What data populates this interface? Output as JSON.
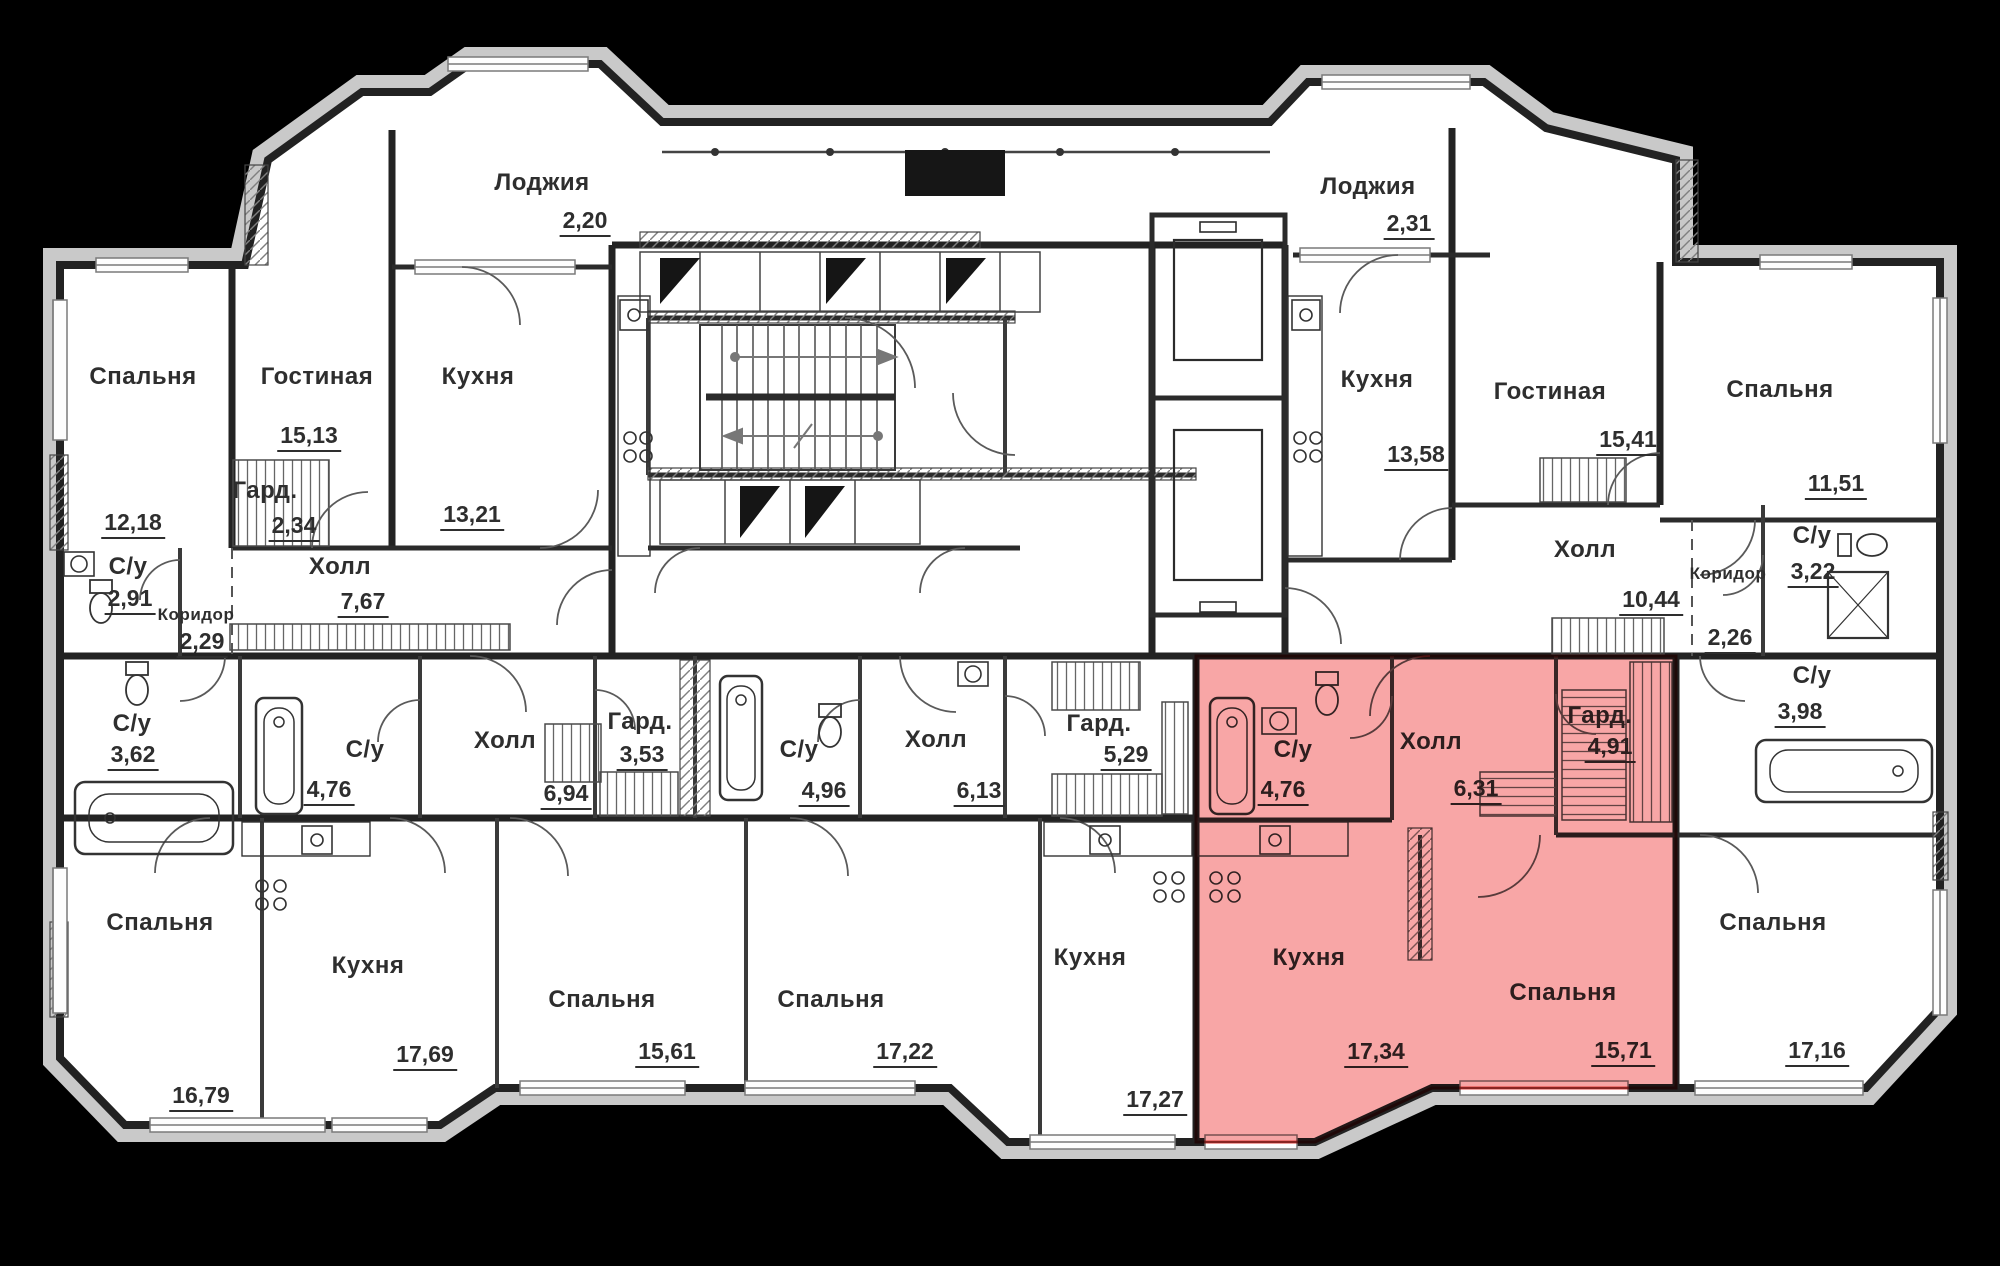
{
  "plan": {
    "highlight": {
      "fill": "#f47070",
      "border": "#e23b38"
    },
    "rooms": [
      {
        "name": "Лоджия",
        "area": "2,20",
        "highlighted": false
      },
      {
        "name": "Спальня",
        "area": "12,18",
        "highlighted": false
      },
      {
        "name": "Гостиная",
        "area": "15,13",
        "highlighted": false
      },
      {
        "name": "Гард.",
        "area": "2,34",
        "highlighted": false
      },
      {
        "name": "Кухня",
        "area": "13,21",
        "highlighted": false
      },
      {
        "name": "С/у",
        "area": "2,91",
        "highlighted": false
      },
      {
        "name": "Коридор",
        "area": "2,29",
        "highlighted": false
      },
      {
        "name": "Холл",
        "area": "7,67",
        "highlighted": false
      },
      {
        "name": "Лоджия",
        "area": "2,31",
        "highlighted": false
      },
      {
        "name": "Кухня",
        "area": "13,58",
        "highlighted": false
      },
      {
        "name": "Гостиная",
        "area": "15,41",
        "highlighted": false
      },
      {
        "name": "Спальня",
        "area": "11,51",
        "highlighted": false
      },
      {
        "name": "Холл",
        "area": "10,44",
        "highlighted": false
      },
      {
        "name": "Коридор",
        "area": "2,26",
        "highlighted": false
      },
      {
        "name": "С/у",
        "area": "3,22",
        "highlighted": false
      },
      {
        "name": "С/у",
        "area": "3,98",
        "highlighted": false
      },
      {
        "name": "С/у",
        "area": "3,62",
        "highlighted": false
      },
      {
        "name": "Спальня",
        "area": "16,79",
        "highlighted": false
      },
      {
        "name": "Кухня",
        "area": "17,69",
        "highlighted": false
      },
      {
        "name": "С/у",
        "area": "4,76",
        "highlighted": false
      },
      {
        "name": "Холл",
        "area": "6,94",
        "highlighted": false
      },
      {
        "name": "Гард.",
        "area": "3,53",
        "highlighted": false
      },
      {
        "name": "Спальня",
        "area": "15,61",
        "highlighted": false
      },
      {
        "name": "С/у",
        "area": "4,96",
        "highlighted": false
      },
      {
        "name": "Холл",
        "area": "6,13",
        "highlighted": false
      },
      {
        "name": "Гард.",
        "area": "5,29",
        "highlighted": false
      },
      {
        "name": "Спальня",
        "area": "17,22",
        "highlighted": false
      },
      {
        "name": "Кухня",
        "area": "17,27",
        "highlighted": false
      },
      {
        "name": "С/у",
        "area": "4,76",
        "highlighted": true
      },
      {
        "name": "Холл",
        "area": "6,31",
        "highlighted": true
      },
      {
        "name": "Гард.",
        "area": "4,91",
        "highlighted": true
      },
      {
        "name": "Кухня",
        "area": "17,34",
        "highlighted": true
      },
      {
        "name": "Спальня",
        "area": "15,71",
        "highlighted": true
      },
      {
        "name": "Спальня",
        "area": "17,16",
        "highlighted": false
      }
    ]
  }
}
